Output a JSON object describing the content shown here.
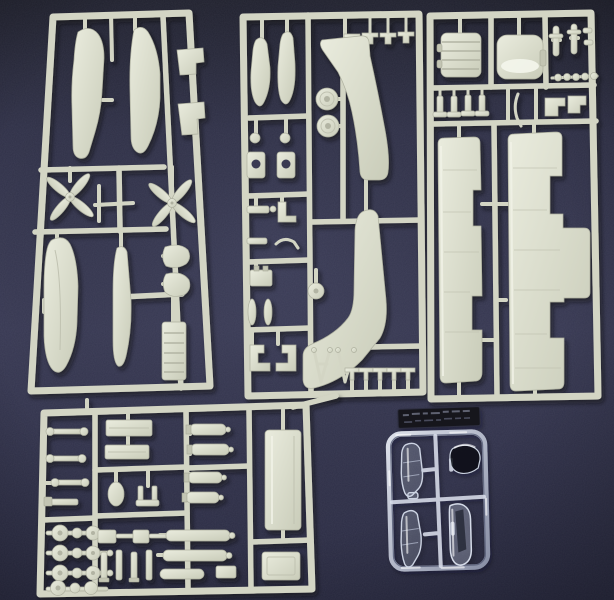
{
  "meta": {
    "type": "photograph",
    "subject": "Five injection-molded plastic model aircraft kit sprues laid out on dark navy fabric",
    "sprue_count": 5,
    "readable_text": "none",
    "notes": "Clear sprue carries a small embossed manufacturer tag that is not legible in the photo"
  },
  "palette": {
    "background_navy": "#343650",
    "background_navy_dark": "#212230",
    "plastic_light": "#e9ebdd",
    "plastic_mid": "#d3d5c4",
    "plastic_shadow": "#aeb09f",
    "clear_plastic_highlight": "#e8edf6",
    "tag_dark": "#15161f"
  },
  "sprues": [
    {
      "id": "A",
      "name": "sprue-a-fuselage-and-floats",
      "position": "top-left",
      "material": "light grey styrene",
      "contents": [
        "fuselage half",
        "curved fuselage half",
        "stepped bracket x2",
        "four-blade propeller x2",
        "large float half",
        "narrow blade part",
        "cowl piece x2",
        "ribbed hatch panel"
      ]
    },
    {
      "id": "B",
      "name": "sprue-b-main-float-and-fittings",
      "position": "top-center",
      "material": "light grey styrene",
      "contents": [
        "rack cross fitting x4 (top rail)",
        "pontoon half x2",
        "round knob x2",
        "drilled plate x2",
        "wheel x2",
        "main float half upper",
        "main float half lower",
        "A-frame strut x2",
        "assorted small struts and fittings",
        "fin fitting x5 (bottom rail)"
      ]
    },
    {
      "id": "C",
      "name": "sprue-c-wings-and-engine",
      "position": "top-right",
      "material": "light grey styrene",
      "contents": [
        "ribbed radial engine block",
        "engine cowling",
        "pushrod part x2",
        "bead chain",
        "hanging tab fitting x4",
        "bent strip",
        "angle bracket x2",
        "long wing half x2 with aileron notches"
      ]
    },
    {
      "id": "D",
      "name": "sprue-d-struts-bombs-wheels",
      "position": "bottom-left",
      "material": "light grey styrene",
      "contents": [
        "dumbbell strut x4",
        "wheel-and-axle set x4",
        "flat panel x2",
        "oval fairing",
        "pronged mount",
        "bomb / drop tank x4",
        "block-and-rod assembly x2",
        "vertical strut x4",
        "torpedo body x3",
        "large rectangular panel",
        "small box part"
      ]
    },
    {
      "id": "E",
      "name": "sprue-e-clear-canopies",
      "position": "bottom-right",
      "material": "clear styrene",
      "contents": [
        "framed canopy section x2",
        "dome windscreen",
        "long canopy section",
        "embossed maker tag (illegible)"
      ],
      "tag_legible": false
    }
  ]
}
